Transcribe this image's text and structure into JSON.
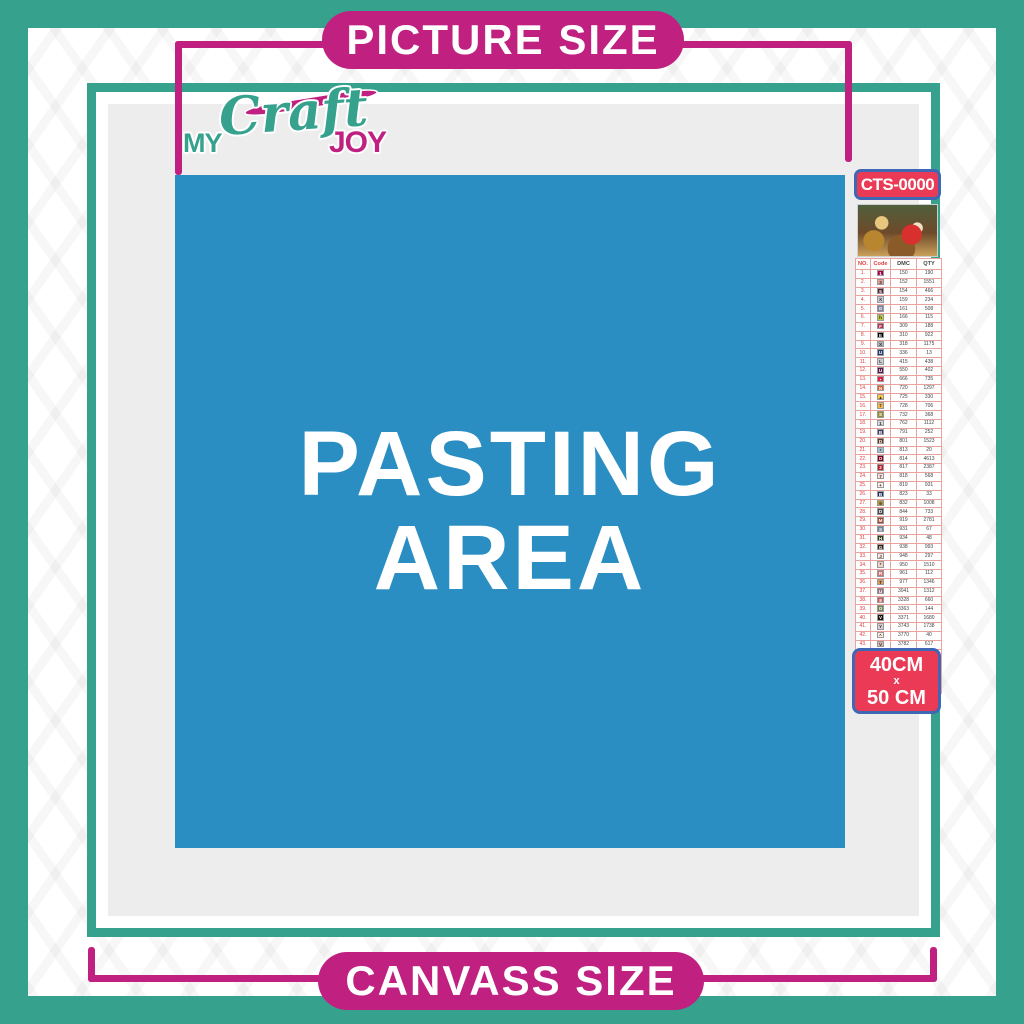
{
  "banners": {
    "top_label": "PICTURE SIZE",
    "bottom_label": "CANVASS SIZE"
  },
  "logo": {
    "word1": "MY",
    "word2": "Craft",
    "word3": "JOY"
  },
  "pasting_area": {
    "line1": "PASTING",
    "line2": "AREA"
  },
  "sidebar": {
    "sku": "CTS-0000",
    "size_line1": "40CM",
    "size_line2": "x",
    "size_line3": "50 CM",
    "table": {
      "headers": [
        "NO.",
        "Code",
        "DMC",
        "QTY"
      ],
      "rows": [
        {
          "no": "1.",
          "symbol": "1",
          "box": "#ab0249",
          "dmc": "150",
          "qty": "190"
        },
        {
          "no": "2.",
          "symbol": "3",
          "box": "#e2a099",
          "dmc": "152",
          "qty": "1551"
        },
        {
          "no": "3.",
          "symbol": "5",
          "box": "#572433",
          "dmc": "154",
          "qty": "466"
        },
        {
          "no": "4.",
          "symbol": "X",
          "box": "#c7cad7",
          "dmc": "159",
          "qty": "234"
        },
        {
          "no": "5.",
          "symbol": "G",
          "box": "#7880a4",
          "dmc": "161",
          "qty": "508"
        },
        {
          "no": "6.",
          "symbol": "h",
          "box": "#c0c840",
          "dmc": "166",
          "qty": "115"
        },
        {
          "no": "7.",
          "symbol": "F",
          "box": "#ba2c4b",
          "dmc": "309",
          "qty": "188"
        },
        {
          "no": "8.",
          "symbol": "E",
          "box": "#000000",
          "dmc": "310",
          "qty": "922"
        },
        {
          "no": "9.",
          "symbol": "X",
          "box": "#abb1b8",
          "dmc": "318",
          "qty": "1175"
        },
        {
          "no": "10.",
          "symbol": "U",
          "box": "#253b73",
          "dmc": "336",
          "qty": "13"
        },
        {
          "no": "11.",
          "symbol": "L",
          "box": "#cdcdd3",
          "dmc": "415",
          "qty": "438"
        },
        {
          "no": "12.",
          "symbol": "U",
          "box": "#5c184e",
          "dmc": "550",
          "qty": "402"
        },
        {
          "no": "13.",
          "symbol": "▪",
          "box": "#e31d42",
          "dmc": "666",
          "qty": "735"
        },
        {
          "no": "14.",
          "symbol": "N",
          "box": "#e55c1f",
          "dmc": "720",
          "qty": "1297"
        },
        {
          "no": "15.",
          "symbol": "▲",
          "box": "#ffc840",
          "dmc": "725",
          "qty": "330"
        },
        {
          "no": "16.",
          "symbol": "7",
          "box": "#f0b84c",
          "dmc": "728",
          "qty": "706"
        },
        {
          "no": "17.",
          "symbol": "S",
          "box": "#948c28",
          "dmc": "732",
          "qty": "368"
        },
        {
          "no": "18.",
          "symbol": "1",
          "box": "#d8d9dc",
          "dmc": "762",
          "qty": "1112"
        },
        {
          "no": "19.",
          "symbol": "B",
          "box": "#343b68",
          "dmc": "791",
          "qty": "252"
        },
        {
          "no": "20.",
          "symbol": "D",
          "box": "#653919",
          "dmc": "801",
          "qty": "1523"
        },
        {
          "no": "21.",
          "symbol": "*",
          "box": "#a1c2d7",
          "dmc": "813",
          "qty": "20"
        },
        {
          "no": "22.",
          "symbol": "O",
          "box": "#7b001b",
          "dmc": "814",
          "qty": "4613"
        },
        {
          "no": "23.",
          "symbol": "2",
          "box": "#bb1f2d",
          "dmc": "817",
          "qty": "2387"
        },
        {
          "no": "24.",
          "symbol": "7",
          "box": "#ffdfd9",
          "dmc": "818",
          "qty": "568"
        },
        {
          "no": "25.",
          "symbol": "+",
          "box": "#ffeee3",
          "dmc": "819",
          "qty": "931"
        },
        {
          "no": "26.",
          "symbol": "B",
          "box": "#213063",
          "dmc": "823",
          "qty": "33"
        },
        {
          "no": "27.",
          "symbol": "9",
          "box": "#bd9b33",
          "dmc": "832",
          "qty": "1008"
        },
        {
          "no": "28.",
          "symbol": "D",
          "box": "#484848",
          "dmc": "844",
          "qty": "733"
        },
        {
          "no": "29.",
          "symbol": "M",
          "box": "#a64526",
          "dmc": "919",
          "qty": "2781"
        },
        {
          "no": "30.",
          "symbol": "S",
          "box": "#6a859e",
          "dmc": "931",
          "qty": "67"
        },
        {
          "no": "31.",
          "symbol": "H",
          "box": "#313919",
          "dmc": "934",
          "qty": "48"
        },
        {
          "no": "32.",
          "symbol": "G",
          "box": "#361f0e",
          "dmc": "938",
          "qty": "993"
        },
        {
          "no": "33.",
          "symbol": "J",
          "box": "#fee7da",
          "dmc": "948",
          "qty": "297"
        },
        {
          "no": "34.",
          "symbol": "*",
          "box": "#eed3c4",
          "dmc": "950",
          "qty": "1510"
        },
        {
          "no": "35.",
          "symbol": "R",
          "box": "#cf7373",
          "dmc": "961",
          "qty": "112"
        },
        {
          "no": "36.",
          "symbol": "T",
          "box": "#dc9c56",
          "dmc": "977",
          "qty": "1346"
        },
        {
          "no": "37.",
          "symbol": "U",
          "box": "#956f7c",
          "dmc": "3041",
          "qty": "1312"
        },
        {
          "no": "38.",
          "symbol": "8",
          "box": "#c65b5b",
          "dmc": "3328",
          "qty": "660"
        },
        {
          "no": "39.",
          "symbol": "O",
          "box": "#6f8352",
          "dmc": "3363",
          "qty": "144"
        },
        {
          "no": "40.",
          "symbol": "V",
          "box": "#1e1108",
          "dmc": "3371",
          "qty": "1680"
        },
        {
          "no": "41.",
          "symbol": "Y",
          "box": "#d7cbd3",
          "dmc": "3743",
          "qty": "1738"
        },
        {
          "no": "42.",
          "symbol": "^",
          "box": "#ffeedb",
          "dmc": "3770",
          "qty": "40"
        },
        {
          "no": "43.",
          "symbol": "V",
          "box": "#d2bca6",
          "dmc": "3782",
          "qty": "617"
        },
        {
          "no": "44.",
          "symbol": "2",
          "box": "#e0e868",
          "dmc": "3819",
          "qty": "119"
        },
        {
          "no": "45.",
          "symbol": "✓",
          "box": "#fffbdc",
          "dmc": "3823",
          "qty": "107"
        },
        {
          "no": "46.",
          "symbol": "C",
          "box": "#f29746",
          "dmc": "3853",
          "qty": "1332"
        },
        {
          "no": "47.",
          "symbol": "D",
          "box": "#7d4b43",
          "dmc": "3858",
          "qty": "2311"
        },
        {
          "no": "48.",
          "symbol": "A",
          "box": "#a4835c",
          "dmc": "3863",
          "qty": "1820"
        }
      ]
    }
  },
  "colors": {
    "teal": "#36a28e",
    "magenta": "#c02180",
    "badge_red": "#ea3a55",
    "badge_border_blue": "#3e68b3",
    "pasting_blue": "#2b8ec3",
    "panel_gray": "#ededee"
  }
}
